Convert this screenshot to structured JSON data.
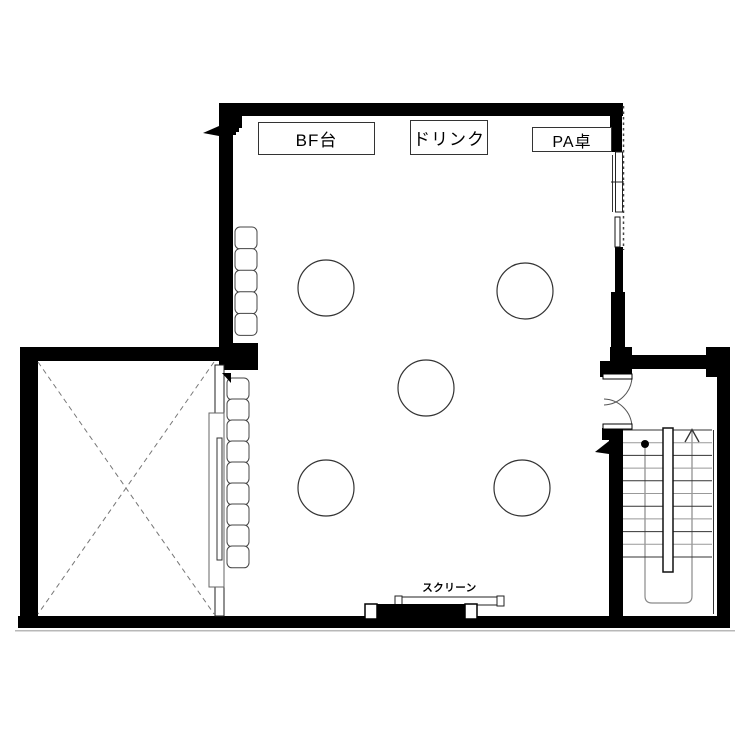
{
  "plan": {
    "labels": {
      "buffet_table": "BF台",
      "drink": "ドリンク",
      "pa_desk": "PA卓",
      "screen": "スクリーン"
    },
    "objects": {
      "round_tables": 5,
      "bench_seats_upper": 5,
      "bench_seats_lower": 9,
      "stair_tread_rows": 11
    },
    "colors": {
      "wall": "#000000",
      "dark_line": "#333333",
      "light_line": "#999999",
      "walkline": "#8a8a8a",
      "background": "#ffffff"
    }
  }
}
